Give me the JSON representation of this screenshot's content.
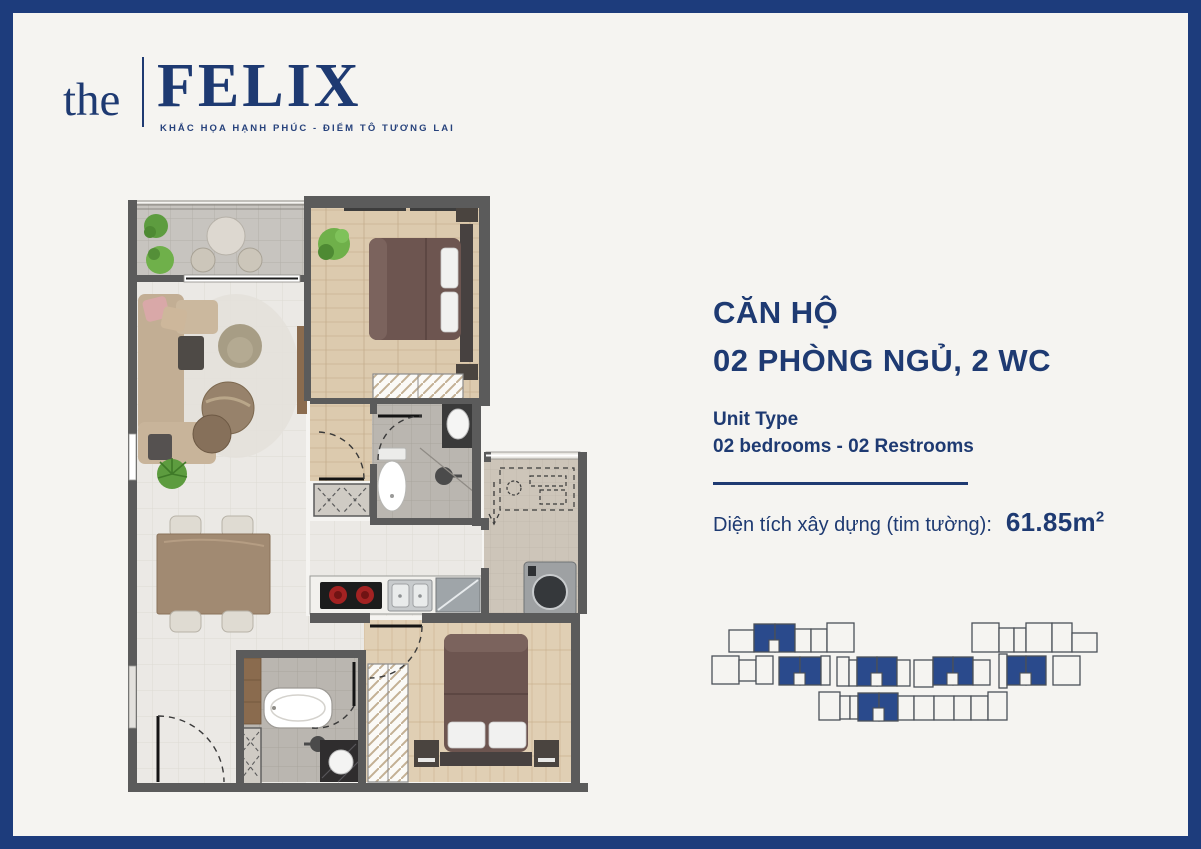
{
  "colors": {
    "brand_navy": "#1e3a72",
    "border_navy": "#1d3c7c",
    "keyplan_highlight_blue": "#2a4a8c",
    "keyplan_outline": "#4b5058",
    "paper_background": "#f5f4f1"
  },
  "logo": {
    "prefix": "the",
    "name": "FELIX",
    "tagline": "KHẮC HỌA HẠNH PHÚC - ĐIỂM TÔ TƯƠNG LAI"
  },
  "unit": {
    "title_line1": "CĂN HỘ",
    "title_line2": "02 PHÒNG NGỦ, 2 WC",
    "type_label": "Unit Type",
    "type_value": "02 bedrooms - 02 Restrooms",
    "area_label": "Diện tích xây dựng (tim tường):",
    "area_value": "61.85m",
    "area_superscript": "2"
  },
  "keyplan": {
    "units": [
      {
        "x": 23,
        "y": 19,
        "w": 25,
        "h": 22,
        "hl": 0
      },
      {
        "x": 48,
        "y": 13,
        "w": 21,
        "h": 28,
        "hl": 1
      },
      {
        "x": 69,
        "y": 13,
        "w": 20,
        "h": 28,
        "hl": 1
      },
      {
        "x": 89,
        "y": 18,
        "w": 16,
        "h": 23,
        "hl": 0
      },
      {
        "x": 105,
        "y": 18,
        "w": 16,
        "h": 23,
        "hl": 0
      },
      {
        "x": 121,
        "y": 12,
        "w": 27,
        "h": 29,
        "hl": 0
      },
      {
        "x": 266,
        "y": 12,
        "w": 27,
        "h": 29,
        "hl": 0
      },
      {
        "x": 293,
        "y": 17,
        "w": 15,
        "h": 24,
        "hl": 0
      },
      {
        "x": 308,
        "y": 17,
        "w": 12,
        "h": 24,
        "hl": 0
      },
      {
        "x": 320,
        "y": 12,
        "w": 26,
        "h": 29,
        "hl": 0
      },
      {
        "x": 346,
        "y": 12,
        "w": 20,
        "h": 29,
        "hl": 0
      },
      {
        "x": 366,
        "y": 22,
        "w": 25,
        "h": 19,
        "hl": 0
      },
      {
        "x": 6,
        "y": 45,
        "w": 27,
        "h": 28,
        "hl": 0
      },
      {
        "x": 33,
        "y": 49,
        "w": 17,
        "h": 21,
        "hl": 0
      },
      {
        "x": 50,
        "y": 45,
        "w": 17,
        "h": 28,
        "hl": 0
      },
      {
        "x": 73,
        "y": 46,
        "w": 21,
        "h": 28,
        "hl": 1
      },
      {
        "x": 94,
        "y": 46,
        "w": 21,
        "h": 28,
        "hl": 1
      },
      {
        "x": 115,
        "y": 45,
        "w": 9,
        "h": 29,
        "hl": 0
      },
      {
        "x": 131,
        "y": 46,
        "w": 12,
        "h": 29,
        "hl": 0
      },
      {
        "x": 143,
        "y": 49,
        "w": 8,
        "h": 26,
        "hl": 0
      },
      {
        "x": 151,
        "y": 46,
        "w": 20,
        "h": 29,
        "hl": 1
      },
      {
        "x": 171,
        "y": 46,
        "w": 20,
        "h": 29,
        "hl": 1
      },
      {
        "x": 191,
        "y": 49,
        "w": 13,
        "h": 26,
        "hl": 0
      },
      {
        "x": 208,
        "y": 49,
        "w": 19,
        "h": 27,
        "hl": 0
      },
      {
        "x": 227,
        "y": 46,
        "w": 20,
        "h": 28,
        "hl": 1
      },
      {
        "x": 247,
        "y": 46,
        "w": 20,
        "h": 28,
        "hl": 1
      },
      {
        "x": 267,
        "y": 49,
        "w": 17,
        "h": 25,
        "hl": 0
      },
      {
        "x": 293,
        "y": 43,
        "w": 8,
        "h": 34,
        "hl": 0
      },
      {
        "x": 301,
        "y": 45,
        "w": 19,
        "h": 29,
        "hl": 1
      },
      {
        "x": 320,
        "y": 45,
        "w": 20,
        "h": 29,
        "hl": 1
      },
      {
        "x": 347,
        "y": 45,
        "w": 27,
        "h": 29,
        "hl": 0
      },
      {
        "x": 113,
        "y": 81,
        "w": 21,
        "h": 28,
        "hl": 0
      },
      {
        "x": 134,
        "y": 85,
        "w": 10,
        "h": 23,
        "hl": 0
      },
      {
        "x": 144,
        "y": 85,
        "w": 8,
        "h": 23,
        "hl": 0
      },
      {
        "x": 152,
        "y": 82,
        "w": 21,
        "h": 28,
        "hl": 1
      },
      {
        "x": 173,
        "y": 82,
        "w": 19,
        "h": 28,
        "hl": 1
      },
      {
        "x": 192,
        "y": 85,
        "w": 16,
        "h": 24,
        "hl": 0
      },
      {
        "x": 208,
        "y": 85,
        "w": 20,
        "h": 24,
        "hl": 0
      },
      {
        "x": 228,
        "y": 85,
        "w": 20,
        "h": 24,
        "hl": 0
      },
      {
        "x": 248,
        "y": 85,
        "w": 17,
        "h": 24,
        "hl": 0
      },
      {
        "x": 265,
        "y": 85,
        "w": 17,
        "h": 24,
        "hl": 0
      },
      {
        "x": 282,
        "y": 81,
        "w": 19,
        "h": 28,
        "hl": 0
      }
    ],
    "notches": [
      {
        "x": 63,
        "y": 29,
        "w": 10,
        "h": 12
      },
      {
        "x": 88,
        "y": 62,
        "w": 11,
        "h": 12
      },
      {
        "x": 165,
        "y": 62,
        "w": 11,
        "h": 13
      },
      {
        "x": 241,
        "y": 62,
        "w": 11,
        "h": 12
      },
      {
        "x": 314,
        "y": 62,
        "w": 11,
        "h": 12
      },
      {
        "x": 167,
        "y": 97,
        "w": 11,
        "h": 13
      }
    ]
  }
}
